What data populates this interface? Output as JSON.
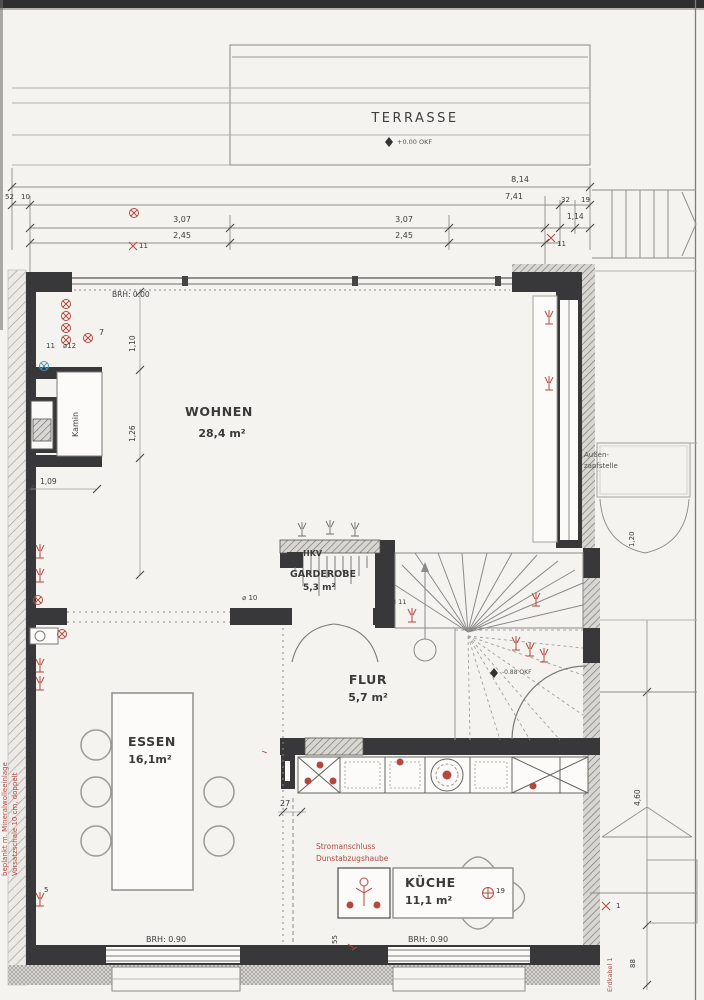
{
  "rooms": {
    "terrasse": {
      "name": "TERRASSE"
    },
    "wohnen": {
      "name": "WOHNEN",
      "area": "28,4 m²",
      "sill": "BRH: 0.00"
    },
    "kamin": {
      "name": "Kamin"
    },
    "hkv": {
      "name": "HKV"
    },
    "garderobe": {
      "name": "GARDEROBE",
      "area": "5,3 m²"
    },
    "flur": {
      "name": "FLUR",
      "area": "5,7 m²"
    },
    "essen": {
      "name": "ESSEN",
      "area": "16,1m²",
      "sill": "BRH: 0.90"
    },
    "kueche": {
      "name": "KÜCHE",
      "area": "11,1 m²",
      "sill": "BRH: 0.90"
    }
  },
  "levels": {
    "terrasse": "+0.00 OKF",
    "treppe": "-0.88 OKF"
  },
  "dims": {
    "total": "8,14",
    "inner": "7,41",
    "left_a": "3,07",
    "left_b": "2,45",
    "right_a": "3,07",
    "right_b": "2,45",
    "entry": "1,14",
    "w32": "32",
    "w19": "19",
    "w52": "52",
    "w10": "10",
    "v110": "1,10",
    "v126": "1,26",
    "kamin_w": "1,09",
    "island": "27",
    "k55": "55",
    "side": "4,60",
    "side_b": "88",
    "door": "1,20"
  },
  "notes": {
    "vorsatz1": "Vorsatzschale 10 cm, doppelt",
    "vorsatz2": "beplankt m. Mineralwolleeinlage",
    "strom1": "Stromanschluss",
    "strom2": "Dunstabzugshaube",
    "aussen1": "Außen-",
    "aussen2": "zapfstelle",
    "erdkabel": "Erdkabel 1"
  },
  "marks": {
    "m7": "7",
    "m11_left": "11",
    "m12": "⌀12",
    "m11_dim_l": "11",
    "m11_dim_r": "11",
    "m10": "⌀ 10",
    "m311": "3 11",
    "m5": "5",
    "m19": "19",
    "m1": "1"
  },
  "colors": {
    "wall": "#38383a",
    "red": "#b2493e",
    "blue": "#4d96c5",
    "line": "#8a8a88",
    "paper": "#f4f3f0"
  }
}
